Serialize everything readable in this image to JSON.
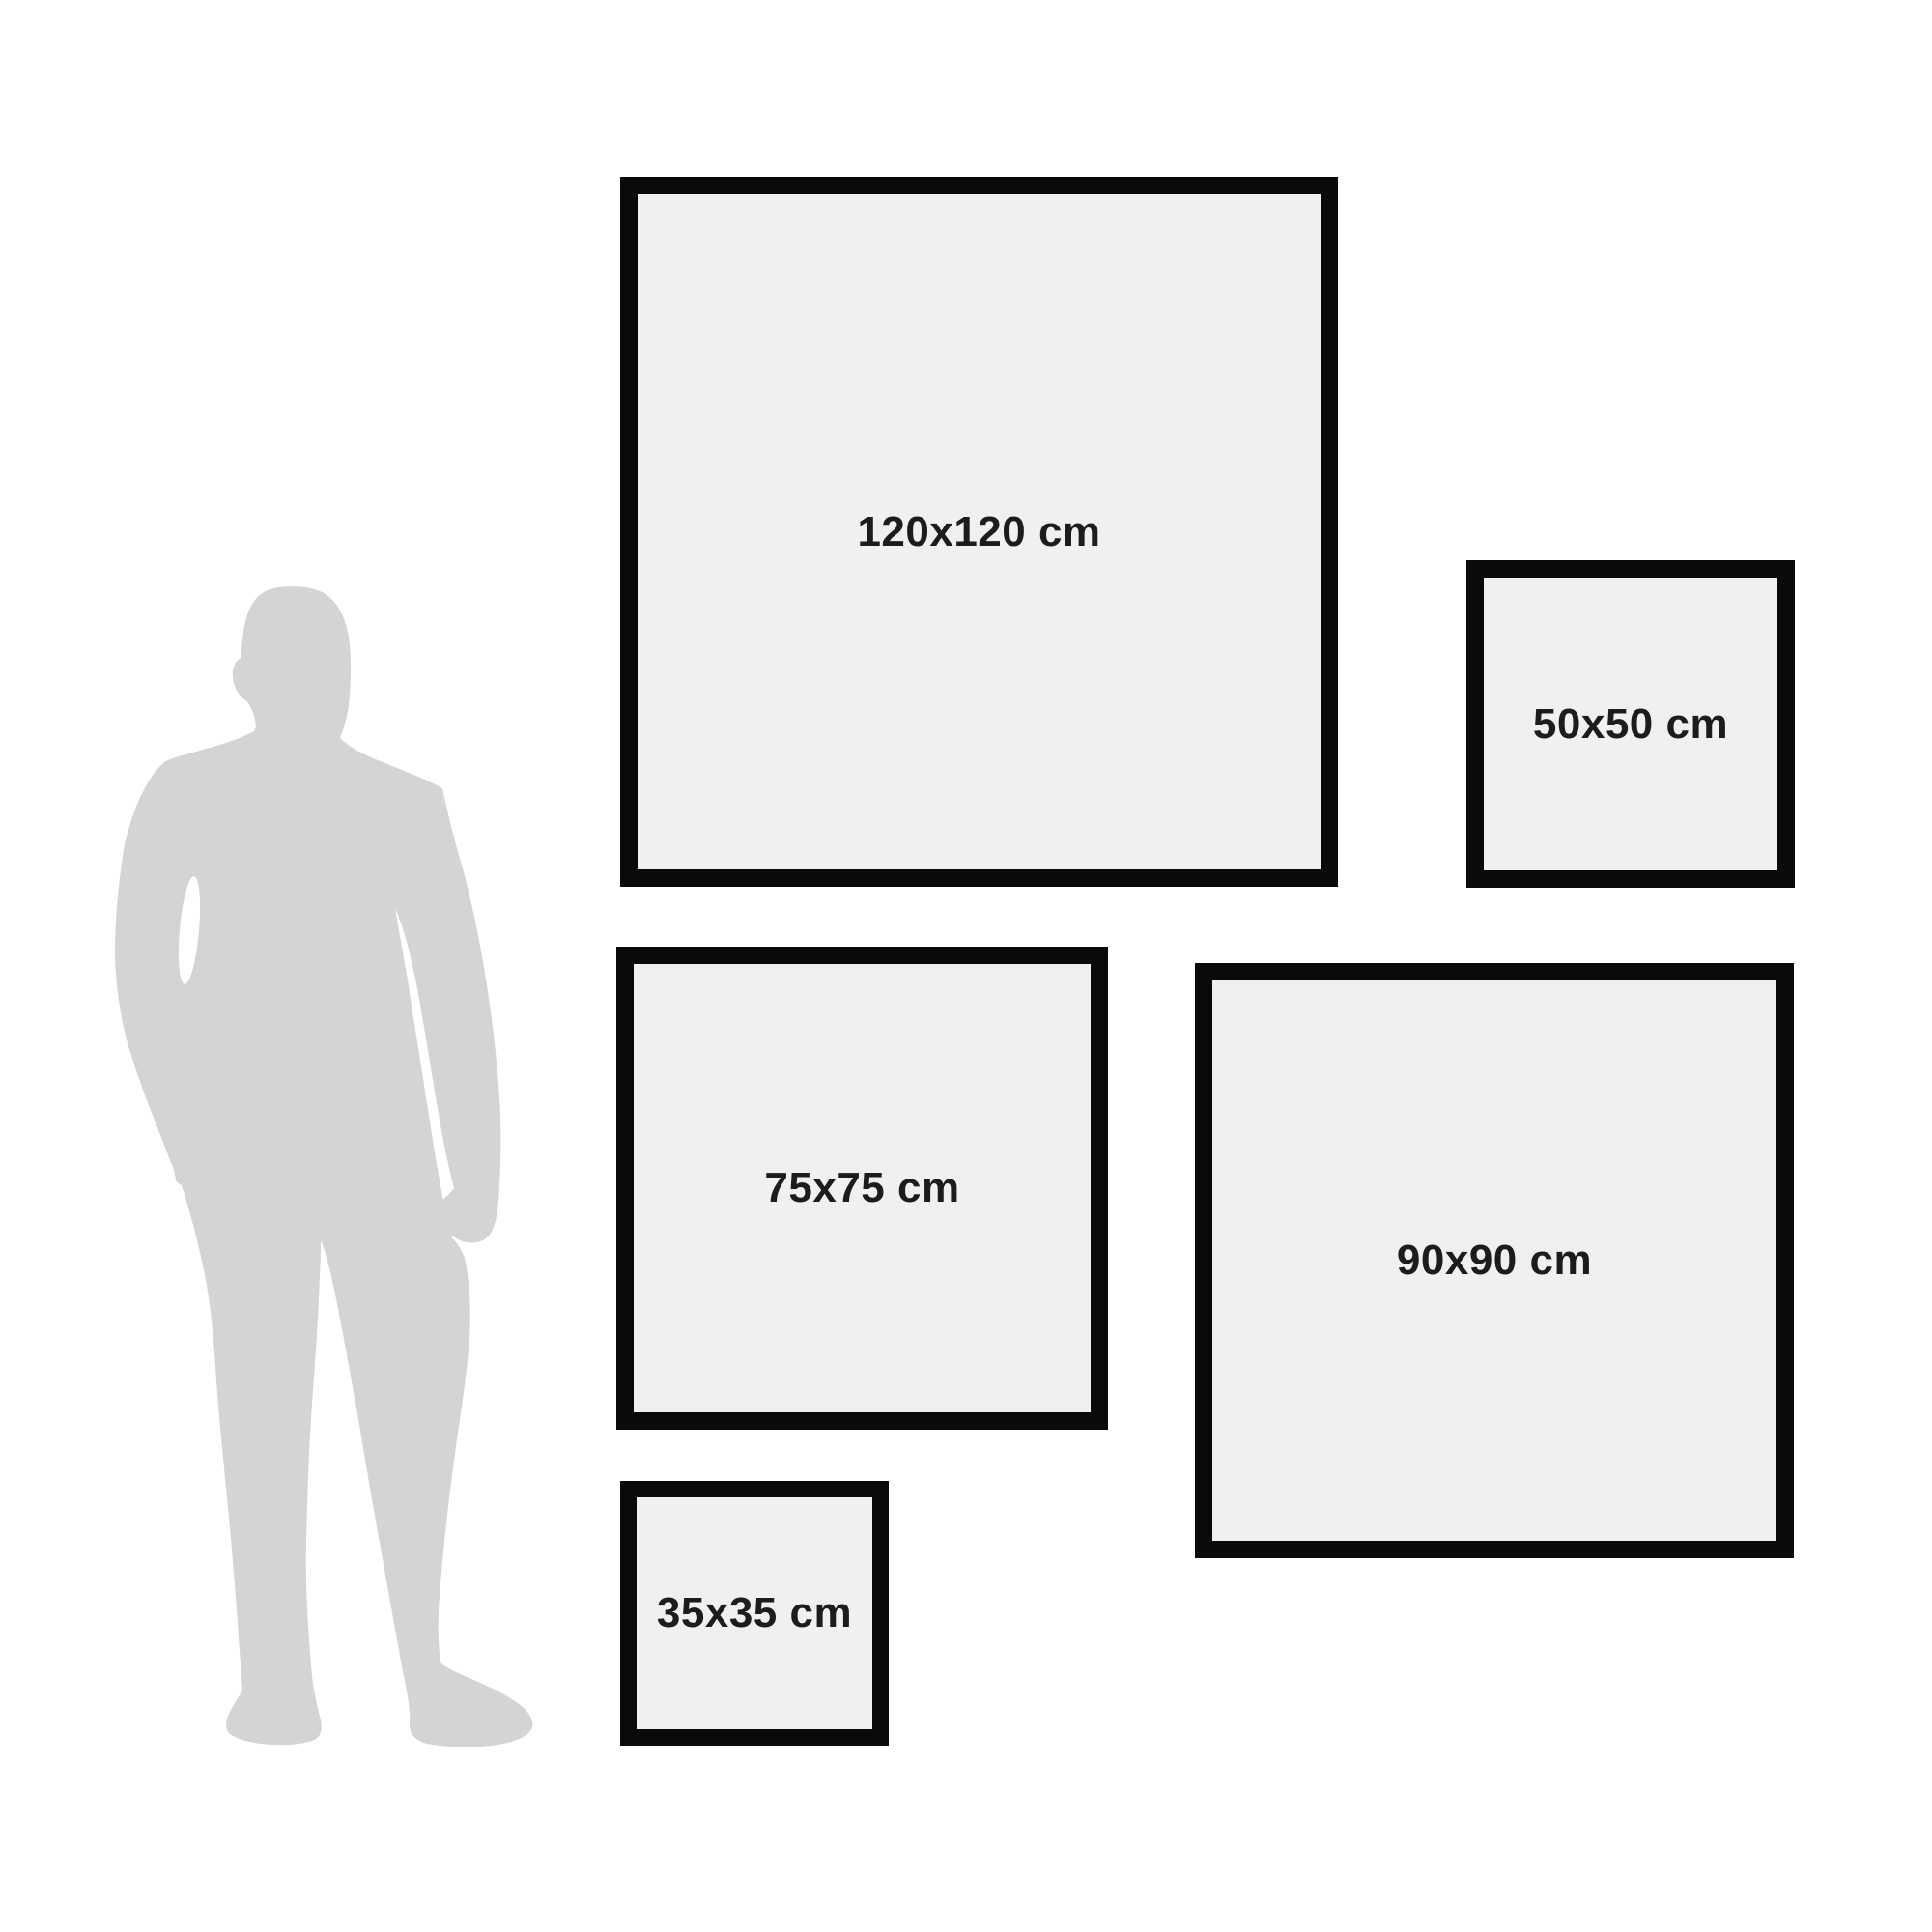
{
  "frames": [
    {
      "id": "120x120",
      "label": "120x120 cm",
      "width_cm": 120,
      "height_cm": 120
    },
    {
      "id": "50x50",
      "label": "50x50 cm",
      "width_cm": 50,
      "height_cm": 50
    },
    {
      "id": "75x75",
      "label": "75x75 cm",
      "width_cm": 75,
      "height_cm": 75
    },
    {
      "id": "90x90",
      "label": "90x90 cm",
      "width_cm": 90,
      "height_cm": 90
    },
    {
      "id": "35x35",
      "label": "35x35 cm",
      "width_cm": 35,
      "height_cm": 35
    }
  ],
  "person": {
    "icon": "man-silhouette-icon"
  },
  "colors": {
    "background": "#ffffff",
    "frame-border": "#0a0a0a",
    "frame-fill": "#f0f0f0",
    "silhouette": "#d3d4d6",
    "label-text": "#1c1c1c"
  }
}
